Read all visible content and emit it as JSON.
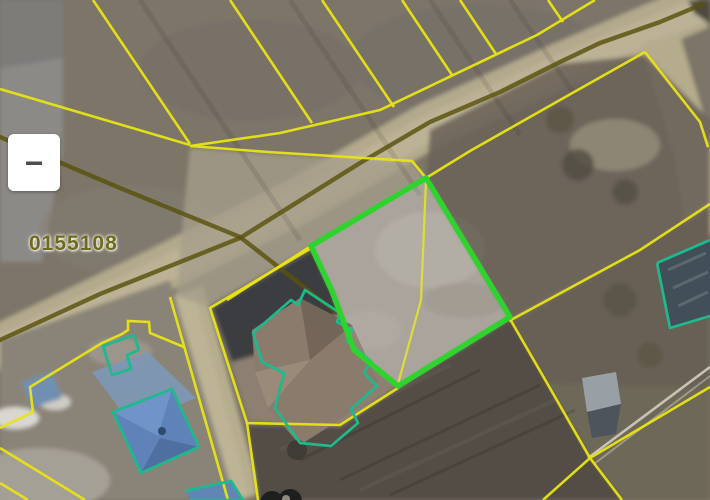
{
  "window": {
    "width": 710,
    "height": 500,
    "kind": "cadastral-map-satellite-view"
  },
  "controls": {
    "zoom_out_glyph": "−"
  },
  "map": {
    "quarter_label": "0155108",
    "selected_parcel": {
      "state": "selected",
      "outline": "bright-green"
    },
    "bottom_edge_marker": "partial dark glyph cut off by viewport"
  },
  "colors": {
    "parcel-yellow": "#e8e414",
    "quarter-olive": "#59520e",
    "selected-green": "#2ed32e",
    "building-teal": "#1eb98d",
    "label-olive": "#6e6b1d",
    "road-tan": "#b3a98c",
    "field-dark": "#534d44",
    "field-base": "#7b7468"
  }
}
